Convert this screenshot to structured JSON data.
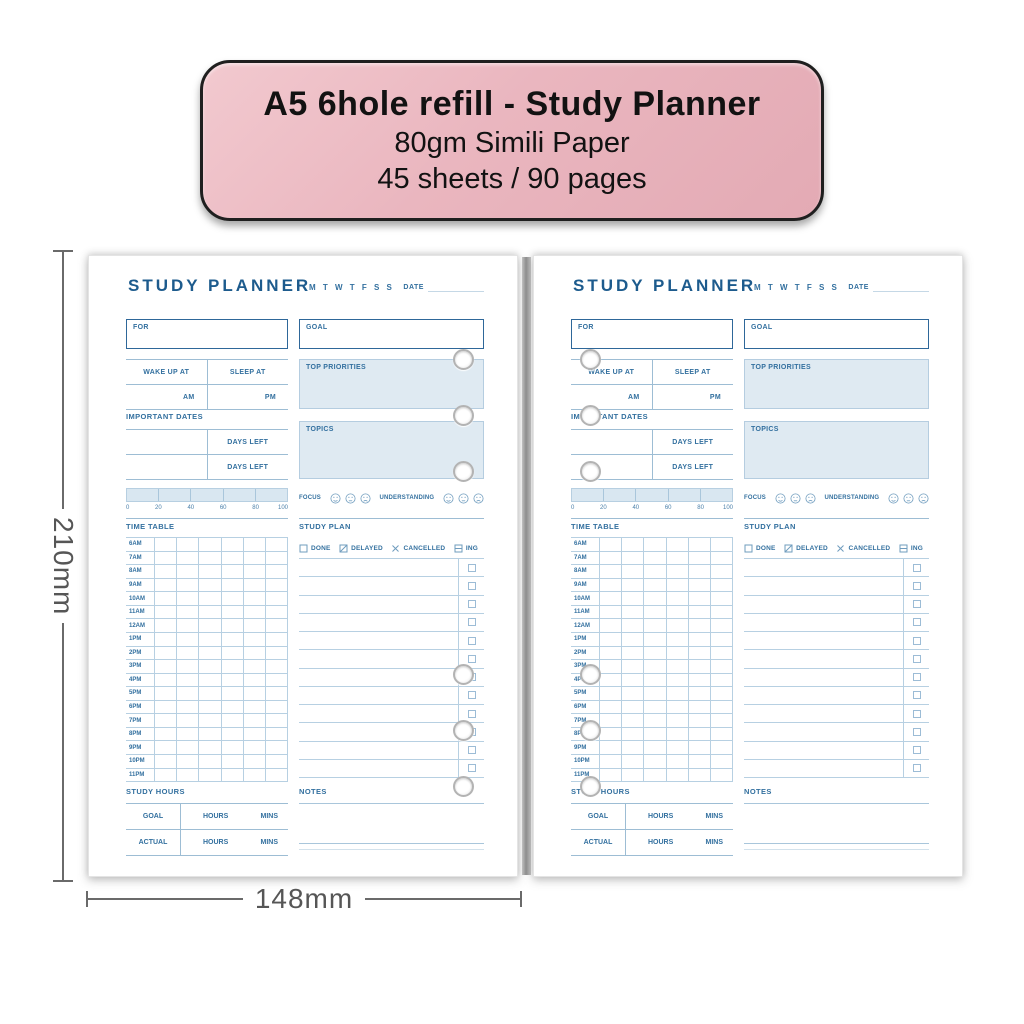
{
  "banner": {
    "title": "A5 6hole refill - Study Planner",
    "subtitle1": "80gm Simili Paper",
    "subtitle2": "45 sheets / 90 pages"
  },
  "dimensions": {
    "height_label": "210mm",
    "width_label": "148mm"
  },
  "page": {
    "title": "STUDY PLANNER",
    "week_days": "M T W T F S S",
    "date_label": "DATE",
    "for_label": "FOR",
    "goal_label": "GOAL",
    "wake_up_label": "WAKE UP AT",
    "sleep_at_label": "SLEEP AT",
    "am_label": "AM",
    "pm_label": "PM",
    "important_dates_label": "IMPORTANT DATES",
    "days_left_label": "DAYS LEFT",
    "top_priorities_label": "TOP PRIORITIES",
    "topics_label": "TOPICS",
    "progress": {
      "ticks": [
        "0",
        "20",
        "40",
        "60",
        "80",
        "100"
      ]
    },
    "ratings": {
      "focus_label": "FOCUS",
      "understanding_label": "UNDERSTANDING",
      "faces": [
        "smile",
        "neutral",
        "frown"
      ]
    },
    "time_table": {
      "label": "TIME TABLE",
      "columns": 6,
      "hours": [
        "6AM",
        "7AM",
        "8AM",
        "9AM",
        "10AM",
        "11AM",
        "12AM",
        "1PM",
        "2PM",
        "3PM",
        "4PM",
        "5PM",
        "6PM",
        "7PM",
        "8PM",
        "9PM",
        "10PM",
        "11PM"
      ]
    },
    "study_plan": {
      "label": "STUDY PLAN",
      "row_count": 12,
      "legend": [
        {
          "icon": "checkbox-empty-icon",
          "label": "DONE"
        },
        {
          "icon": "checkbox-slash-icon",
          "label": "DELAYED"
        },
        {
          "icon": "x-mark-icon",
          "label": "CANCELLED"
        },
        {
          "icon": "checkbox-dash-icon",
          "label": "ING"
        }
      ]
    },
    "study_hours": {
      "label": "STUDY HOURS",
      "rows": [
        {
          "label": "GOAL",
          "hours_label": "HOURS",
          "mins_label": "MINS"
        },
        {
          "label": "ACTUAL",
          "hours_label": "HOURS",
          "mins_label": "MINS"
        }
      ]
    },
    "notes_label": "NOTES"
  },
  "colors": {
    "banner_bg": "#eab6bf",
    "banner_border": "#1f1f1f",
    "planner_blue": "#33709f",
    "planner_dark_blue": "#1d5b8d",
    "line_blue": "#aac7db",
    "fill_blue": "#dfeaf2",
    "dimension_gray": "#5a5a5a"
  }
}
